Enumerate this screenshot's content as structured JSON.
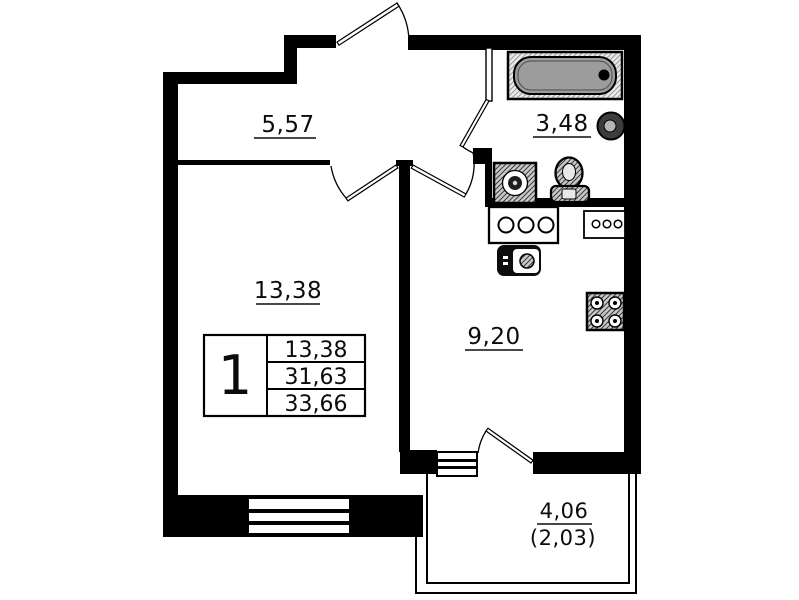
{
  "plan": {
    "type": "apartment-floor-plan",
    "rooms": {
      "hallway": {
        "area": "5,57"
      },
      "bathroom": {
        "area": "3,48"
      },
      "living_room": {
        "area": "13,38"
      },
      "kitchen": {
        "area": "9,20"
      },
      "balcony": {
        "area": "4,06",
        "area_reduced": "(2,03)"
      }
    },
    "info_table": {
      "rooms_count": "1",
      "rows": [
        "13,38",
        "31,63",
        "33,66"
      ]
    },
    "fixtures": [
      "bathtub-icon",
      "round-sink-icon",
      "washing-machine-icon",
      "toilet-icon",
      "kitchen-sink-counter-icon",
      "vent-unit-icon",
      "dark-sink-unit-icon",
      "stove-icon",
      "window-icon",
      "door-swing-icon"
    ],
    "colors": {
      "wall": "#000000",
      "tub_fill": "#9c9c9c",
      "paper": "#ffffff"
    }
  }
}
